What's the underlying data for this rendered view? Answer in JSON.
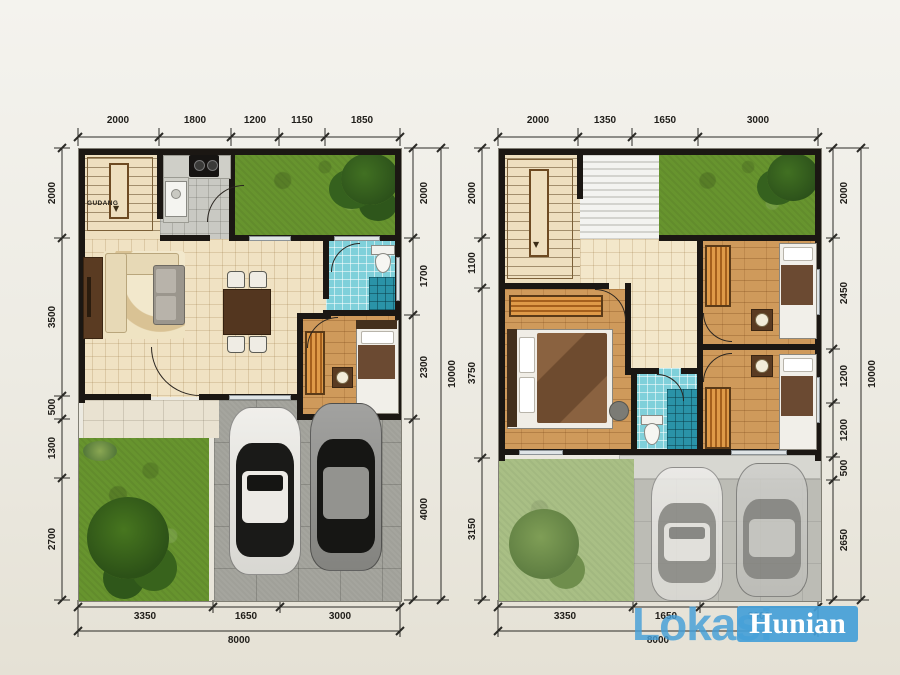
{
  "colors": {
    "watermark_blue": "#459fd8",
    "wall": "#1b1713",
    "grass_green": "#67942e",
    "bath_tile": "#7fd0da",
    "wood_floor": "#cf9a5b"
  },
  "ground_floor": {
    "storage_label": "GUDANG",
    "dims_top": [
      "2000",
      "1800",
      "1200",
      "1150",
      "1850"
    ],
    "dims_left": [
      "2000",
      "3500",
      "500",
      "1300",
      "2700"
    ],
    "dims_right": [
      "2000",
      "1700",
      "2300",
      "4000"
    ],
    "total_height": "10000",
    "dims_bottom": [
      "3350",
      "1650",
      "3000"
    ],
    "total_width": "8000"
  },
  "upper_floor": {
    "dims_top": [
      "2000",
      "1350",
      "1650",
      "3000"
    ],
    "dims_left": [
      "2000",
      "1100",
      "3750",
      "3150"
    ],
    "dims_right": [
      "2000",
      "2450",
      "1200",
      "1200",
      "500",
      "2650"
    ],
    "total_height": "10000",
    "dims_bottom": [
      "3350",
      "1650",
      "3000"
    ],
    "total_width": "8000"
  },
  "watermark": {
    "text_light": "Lokasi",
    "text_box": "Hunian"
  }
}
